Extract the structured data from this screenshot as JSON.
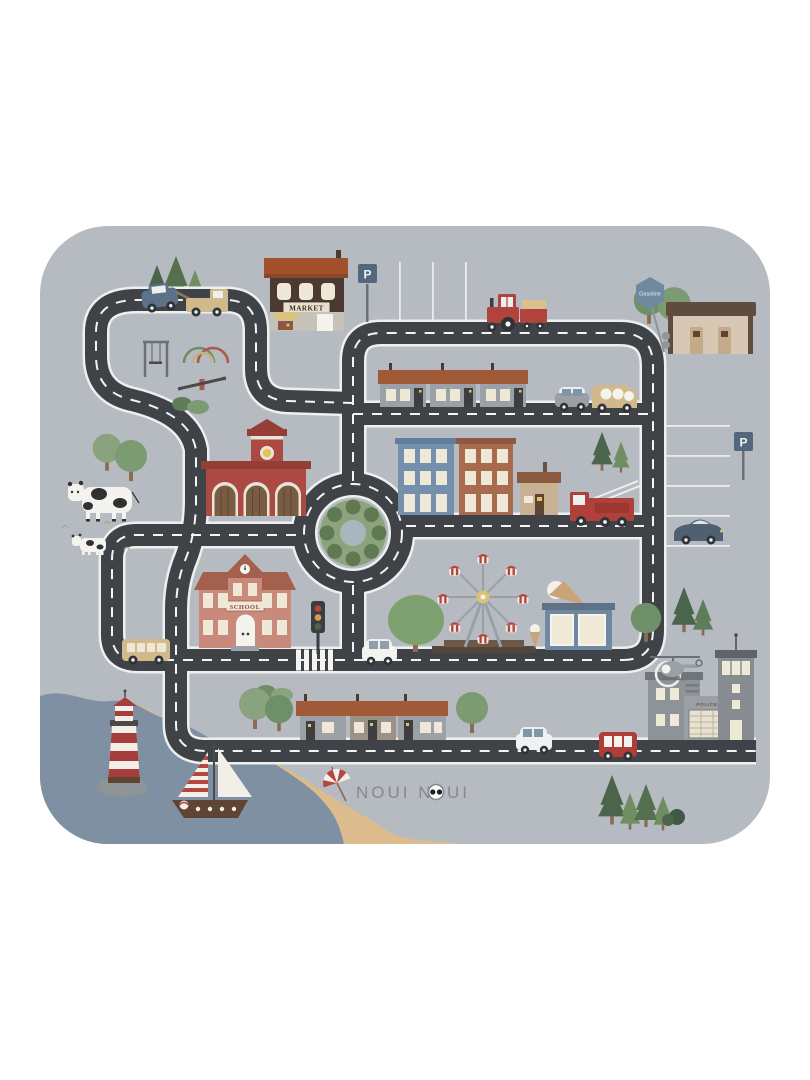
{
  "mat": {
    "product": "kids road play mat",
    "brand": "NOUI NOUI",
    "logo": {
      "part1": "NOUI N",
      "part2": "UI"
    },
    "labels": {
      "market": "MARKET",
      "gasoline": "Gasoline",
      "school": "SCHOOL",
      "police": "POLICE",
      "parking": "P"
    },
    "colors": {
      "page_background": "#ffffff",
      "mat_gray": "#b6bbc1",
      "road_dark": "#3f4347",
      "road_edge": "#edf0ef",
      "road_dash": "#f4f5f3",
      "roof_rust": "#a15a38",
      "fire_station_red": "#ab4a42",
      "school_salmon": "#c9897b",
      "apartment_blue": "#7590ac",
      "apartment_rust": "#a86b4d",
      "sea_blue": "#7e90a1",
      "sand": "#dcbc8e",
      "tree_green": "#7d9b72",
      "pine_green": "#4a654c",
      "vehicle_red": "#ae3f38",
      "vehicle_tan": "#d2b98c",
      "sign_blue": "#53687d",
      "gondola_red": "#b5463f"
    },
    "objects": [
      "tow-truck-with-car",
      "market",
      "parking-sign",
      "parking-lot-lines",
      "tractor-with-trailer",
      "gas-station",
      "gasoline-sign",
      "pine-trees",
      "round-trees",
      "swing-set",
      "climbing-arches",
      "seesaw",
      "bushes",
      "cow",
      "calf",
      "fire-station",
      "roundabout",
      "apartment-buildings",
      "small-house",
      "fire-truck",
      "parked-sports-car",
      "school",
      "traffic-light",
      "crosswalk",
      "big-tree",
      "ferris-wheel",
      "ice-cream-cone",
      "ice-cream-shop",
      "police-station",
      "helicopter",
      "helipad",
      "row-houses",
      "bus",
      "white-car",
      "red-car",
      "gray-car",
      "tan-van",
      "lighthouse",
      "sailboat",
      "beach-umbrella",
      "sea",
      "beach",
      "brand-logo"
    ]
  }
}
